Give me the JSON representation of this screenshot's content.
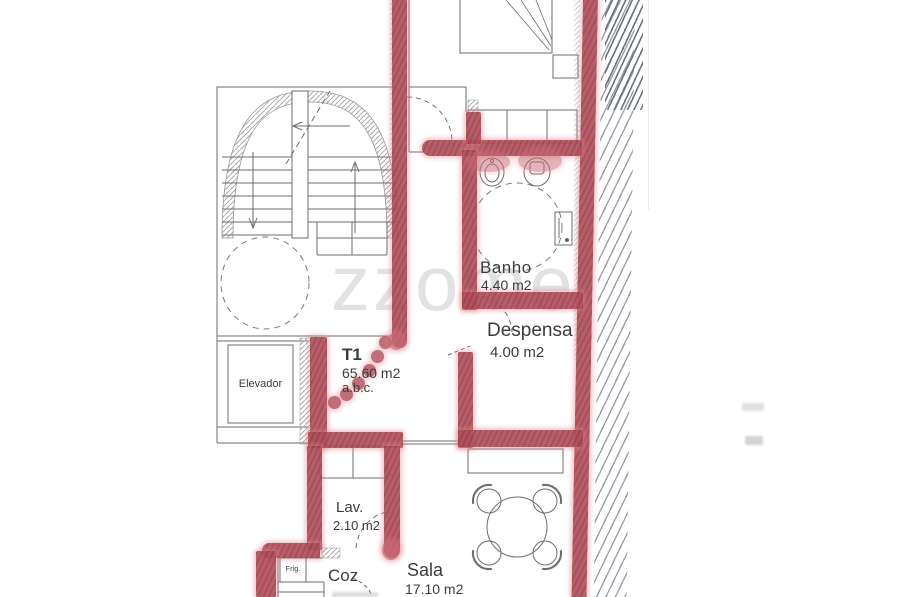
{
  "watermark": {
    "text": "zzome",
    "reg": "®"
  },
  "rooms": {
    "banho": {
      "name": "Banho",
      "area": "4.40 m2"
    },
    "despensa": {
      "name": "Despensa",
      "area": "4.00 m2"
    },
    "unit": {
      "name": "T1",
      "area": "65.60 m2",
      "note": "a.b.c."
    },
    "elevator": {
      "name": "Elevador"
    },
    "lav": {
      "name": "Lav.",
      "area": "2.10 m2"
    },
    "kitchen": {
      "name": "Coz"
    },
    "sala": {
      "name": "Sala",
      "area": "17.10 m2"
    },
    "fridge": {
      "name": "Frig."
    }
  },
  "colors": {
    "marker_highlight": "#b0515d",
    "ink_lines": "#6e6e6e",
    "hatch": "#99a1a8",
    "paper": "#ffffff"
  }
}
